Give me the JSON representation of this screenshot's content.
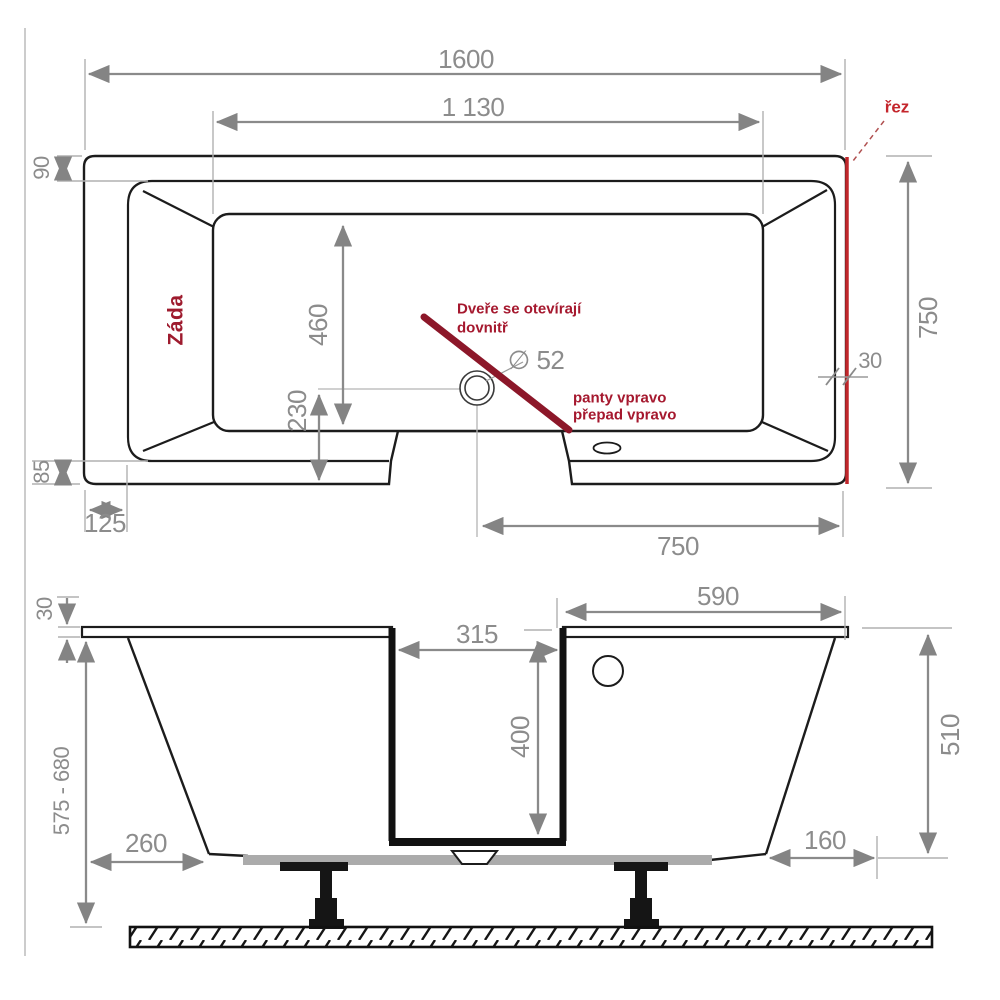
{
  "colors": {
    "dimension_gray": "#8c8c8c",
    "outline_black": "#1c1c1c",
    "section_red": "#c0272b",
    "door_swing_red": "#8c1729",
    "note_red": "#a5182e",
    "support_gray": "#ababab"
  },
  "top": {
    "len_total": "1600",
    "len_inner": "1 130",
    "rim_top": "90",
    "rim_bottom": "85",
    "corner_inset": "125",
    "inner_width": "460",
    "drain_offset": "230",
    "drain_diameter": "∅ 52",
    "bottom_length": "750",
    "right_width": "750",
    "wall_thickness": "30",
    "section_label": "řez",
    "backrest_label": "Záda",
    "door_note_1": "Dveře se otevírají",
    "door_note_2": "dovnitř",
    "hinge_note_1": "panty vpravo",
    "hinge_note_2": "přepad vpravo"
  },
  "front": {
    "rim_thickness": "30",
    "height_range": "575 - 680",
    "left_inset": "260",
    "door_width": "315",
    "door_depth": "400",
    "top_right_length": "590",
    "right_height": "510",
    "right_inset": "160"
  }
}
